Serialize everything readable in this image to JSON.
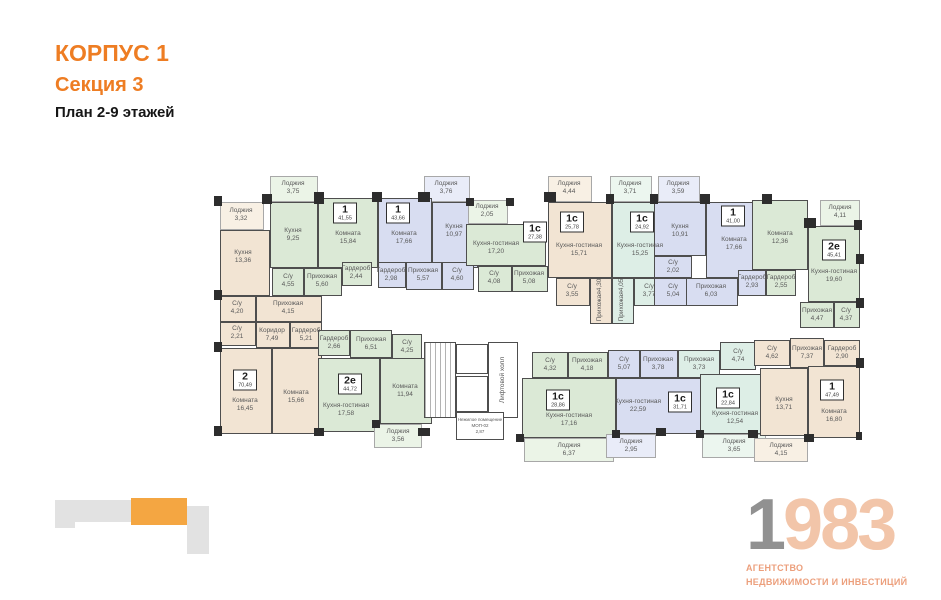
{
  "header": {
    "building": "КОРПУС 1",
    "section": "Секция 3",
    "plan": "План 2-9 этажей"
  },
  "colors": {
    "accent": "#ee7d23",
    "c-bg": "#f2e4d3",
    "c-gn": "#dbe9d6",
    "c-bl": "#d8ddf1",
    "c-mn": "#ddeee6",
    "c-lbg": "#f8f0e4",
    "c-lgn": "#ebf4e7",
    "c-lbl": "#e9ecf8",
    "c-lmn": "#ecf6ef",
    "map-gray": "#e2e2e2",
    "map-orange": "#f4a642",
    "logo-gray": "#919191",
    "logo-salmon": "#f2c5a9",
    "logo-sub": "#ec9f7c"
  },
  "plan": {
    "rooms": [
      {
        "x": 6,
        "y": 44,
        "w": 44,
        "h": 28,
        "c": "lbg"
      },
      {
        "x": 6,
        "y": 72,
        "w": 50,
        "h": 66,
        "c": "bg"
      },
      {
        "x": 6,
        "y": 138,
        "w": 36,
        "h": 26,
        "c": "bg"
      },
      {
        "x": 6,
        "y": 164,
        "w": 36,
        "h": 24,
        "c": "bg"
      },
      {
        "x": 42,
        "y": 138,
        "w": 66,
        "h": 26,
        "c": "bg"
      },
      {
        "x": 42,
        "y": 164,
        "w": 34,
        "h": 26,
        "c": "bg"
      },
      {
        "x": 76,
        "y": 164,
        "w": 32,
        "h": 26,
        "c": "bg"
      },
      {
        "x": 6,
        "y": 190,
        "w": 52,
        "h": 86,
        "c": "bg"
      },
      {
        "x": 58,
        "y": 190,
        "w": 50,
        "h": 86,
        "c": "bg"
      },
      {
        "x": 56,
        "y": 18,
        "w": 48,
        "h": 26,
        "c": "lgn"
      },
      {
        "x": 56,
        "y": 44,
        "w": 48,
        "h": 66,
        "c": "gn"
      },
      {
        "x": 104,
        "y": 40,
        "w": 60,
        "h": 70,
        "c": "gn"
      },
      {
        "x": 58,
        "y": 110,
        "w": 32,
        "h": 28,
        "c": "gn"
      },
      {
        "x": 90,
        "y": 110,
        "w": 38,
        "h": 28,
        "c": "gn"
      },
      {
        "x": 128,
        "y": 104,
        "w": 30,
        "h": 24,
        "c": "gn"
      },
      {
        "x": 210,
        "y": 18,
        "w": 46,
        "h": 26,
        "c": "lbl"
      },
      {
        "x": 164,
        "y": 40,
        "w": 54,
        "h": 70,
        "c": "bl"
      },
      {
        "x": 218,
        "y": 44,
        "w": 46,
        "h": 66,
        "c": "bl"
      },
      {
        "x": 164,
        "y": 104,
        "w": 28,
        "h": 26,
        "c": "bl"
      },
      {
        "x": 192,
        "y": 104,
        "w": 36,
        "h": 28,
        "c": "bl"
      },
      {
        "x": 228,
        "y": 104,
        "w": 32,
        "h": 28,
        "c": "bl"
      },
      {
        "x": 254,
        "y": 42,
        "w": 40,
        "h": 24,
        "c": "lgn"
      },
      {
        "x": 252,
        "y": 66,
        "w": 80,
        "h": 42,
        "c": "gn"
      },
      {
        "x": 264,
        "y": 108,
        "w": 34,
        "h": 26,
        "c": "gn"
      },
      {
        "x": 298,
        "y": 108,
        "w": 36,
        "h": 26,
        "c": "gn"
      },
      {
        "x": 334,
        "y": 18,
        "w": 44,
        "h": 26,
        "c": "lbg"
      },
      {
        "x": 334,
        "y": 44,
        "w": 64,
        "h": 76,
        "c": "bg"
      },
      {
        "x": 342,
        "y": 120,
        "w": 34,
        "h": 28,
        "c": "bg"
      },
      {
        "x": 376,
        "y": 120,
        "w": 22,
        "h": 46,
        "c": "bg"
      },
      {
        "x": 396,
        "y": 18,
        "w": 42,
        "h": 26,
        "c": "lmn"
      },
      {
        "x": 398,
        "y": 44,
        "w": 58,
        "h": 76,
        "c": "mn"
      },
      {
        "x": 398,
        "y": 120,
        "w": 22,
        "h": 46,
        "c": "mn"
      },
      {
        "x": 420,
        "y": 120,
        "w": 32,
        "h": 28,
        "c": "mn"
      },
      {
        "x": 444,
        "y": 18,
        "w": 42,
        "h": 26,
        "c": "lbl"
      },
      {
        "x": 440,
        "y": 44,
        "w": 52,
        "h": 54,
        "c": "bl"
      },
      {
        "x": 440,
        "y": 98,
        "w": 38,
        "h": 22,
        "c": "bl"
      },
      {
        "x": 440,
        "y": 120,
        "w": 38,
        "h": 28,
        "c": "bl"
      },
      {
        "x": 492,
        "y": 44,
        "w": 58,
        "h": 76,
        "c": "bl"
      },
      {
        "x": 472,
        "y": 120,
        "w": 52,
        "h": 28,
        "c": "bl"
      },
      {
        "x": 524,
        "y": 112,
        "w": 28,
        "h": 26,
        "c": "bl"
      },
      {
        "x": 552,
        "y": 112,
        "w": 30,
        "h": 26,
        "c": "gn"
      },
      {
        "x": 538,
        "y": 42,
        "w": 56,
        "h": 70,
        "c": "gn"
      },
      {
        "x": 606,
        "y": 42,
        "w": 40,
        "h": 26,
        "c": "lgn"
      },
      {
        "x": 594,
        "y": 68,
        "w": 52,
        "h": 76,
        "c": "gn"
      },
      {
        "x": 586,
        "y": 144,
        "w": 34,
        "h": 26,
        "c": "gn"
      },
      {
        "x": 620,
        "y": 144,
        "w": 26,
        "h": 26,
        "c": "gn"
      },
      {
        "x": 104,
        "y": 172,
        "w": 32,
        "h": 26,
        "c": "gn"
      },
      {
        "x": 136,
        "y": 172,
        "w": 42,
        "h": 28,
        "c": "gn"
      },
      {
        "x": 178,
        "y": 176,
        "w": 30,
        "h": 26,
        "c": "gn"
      },
      {
        "x": 104,
        "y": 200,
        "w": 62,
        "h": 74,
        "c": "gn"
      },
      {
        "x": 166,
        "y": 200,
        "w": 52,
        "h": 66,
        "c": "gn"
      },
      {
        "x": 160,
        "y": 266,
        "w": 48,
        "h": 24,
        "c": "lgn"
      },
      {
        "x": 210,
        "y": 184,
        "w": 32,
        "h": 76,
        "c": "st"
      },
      {
        "x": 242,
        "y": 186,
        "w": 32,
        "h": 30,
        "c": "wh"
      },
      {
        "x": 242,
        "y": 218,
        "w": 32,
        "h": 36,
        "c": "wh"
      },
      {
        "x": 274,
        "y": 184,
        "w": 30,
        "h": 76,
        "c": "wh"
      },
      {
        "x": 242,
        "y": 254,
        "w": 48,
        "h": 28,
        "c": "wh"
      },
      {
        "x": 318,
        "y": 194,
        "w": 36,
        "h": 26,
        "c": "gn"
      },
      {
        "x": 354,
        "y": 194,
        "w": 40,
        "h": 26,
        "c": "gn"
      },
      {
        "x": 308,
        "y": 220,
        "w": 94,
        "h": 60,
        "c": "gn"
      },
      {
        "x": 310,
        "y": 280,
        "w": 90,
        "h": 24,
        "c": "lgn"
      },
      {
        "x": 394,
        "y": 192,
        "w": 32,
        "h": 28,
        "c": "bl"
      },
      {
        "x": 426,
        "y": 192,
        "w": 38,
        "h": 28,
        "c": "bl"
      },
      {
        "x": 402,
        "y": 220,
        "w": 102,
        "h": 56,
        "c": "bl"
      },
      {
        "x": 392,
        "y": 276,
        "w": 50,
        "h": 24,
        "c": "lbl"
      },
      {
        "x": 464,
        "y": 192,
        "w": 42,
        "h": 28,
        "c": "mn"
      },
      {
        "x": 506,
        "y": 184,
        "w": 36,
        "h": 28,
        "c": "mn"
      },
      {
        "x": 486,
        "y": 216,
        "w": 72,
        "h": 60,
        "c": "mn"
      },
      {
        "x": 488,
        "y": 276,
        "w": 64,
        "h": 24,
        "c": "lmn"
      },
      {
        "x": 540,
        "y": 182,
        "w": 36,
        "h": 26,
        "c": "bg"
      },
      {
        "x": 576,
        "y": 180,
        "w": 34,
        "h": 30,
        "c": "bg"
      },
      {
        "x": 610,
        "y": 182,
        "w": 36,
        "h": 26,
        "c": "bg"
      },
      {
        "x": 546,
        "y": 210,
        "w": 48,
        "h": 68,
        "c": "bg"
      },
      {
        "x": 594,
        "y": 208,
        "w": 52,
        "h": 72,
        "c": "bg"
      },
      {
        "x": 540,
        "y": 280,
        "w": 54,
        "h": 24,
        "c": "lbg"
      }
    ],
    "walls": [
      {
        "x": 48,
        "y": 36,
        "w": 10,
        "h": 10
      },
      {
        "x": 100,
        "y": 34,
        "w": 10,
        "h": 12
      },
      {
        "x": 158,
        "y": 34,
        "w": 10,
        "h": 10
      },
      {
        "x": 204,
        "y": 34,
        "w": 12,
        "h": 10
      },
      {
        "x": 252,
        "y": 40,
        "w": 8,
        "h": 8
      },
      {
        "x": 292,
        "y": 40,
        "w": 8,
        "h": 8
      },
      {
        "x": 330,
        "y": 34,
        "w": 12,
        "h": 10
      },
      {
        "x": 392,
        "y": 36,
        "w": 8,
        "h": 10
      },
      {
        "x": 436,
        "y": 36,
        "w": 8,
        "h": 10
      },
      {
        "x": 486,
        "y": 36,
        "w": 10,
        "h": 10
      },
      {
        "x": 548,
        "y": 36,
        "w": 10,
        "h": 10
      },
      {
        "x": 590,
        "y": 60,
        "w": 12,
        "h": 10
      },
      {
        "x": 640,
        "y": 62,
        "w": 8,
        "h": 10
      },
      {
        "x": 0,
        "y": 38,
        "w": 8,
        "h": 10
      },
      {
        "x": 0,
        "y": 132,
        "w": 8,
        "h": 10
      },
      {
        "x": 0,
        "y": 184,
        "w": 8,
        "h": 10
      },
      {
        "x": 0,
        "y": 268,
        "w": 8,
        "h": 10
      },
      {
        "x": 100,
        "y": 270,
        "w": 10,
        "h": 8
      },
      {
        "x": 158,
        "y": 262,
        "w": 8,
        "h": 8
      },
      {
        "x": 204,
        "y": 270,
        "w": 12,
        "h": 8
      },
      {
        "x": 302,
        "y": 276,
        "w": 8,
        "h": 8
      },
      {
        "x": 398,
        "y": 272,
        "w": 8,
        "h": 8
      },
      {
        "x": 442,
        "y": 270,
        "w": 10,
        "h": 8
      },
      {
        "x": 482,
        "y": 272,
        "w": 8,
        "h": 8
      },
      {
        "x": 534,
        "y": 272,
        "w": 10,
        "h": 8
      },
      {
        "x": 590,
        "y": 276,
        "w": 10,
        "h": 8
      },
      {
        "x": 642,
        "y": 274,
        "w": 6,
        "h": 8
      },
      {
        "x": 642,
        "y": 96,
        "w": 8,
        "h": 10
      },
      {
        "x": 642,
        "y": 140,
        "w": 8,
        "h": 10
      },
      {
        "x": 642,
        "y": 200,
        "w": 8,
        "h": 10
      }
    ],
    "labels": [
      {
        "x": 27,
        "y": 57,
        "n": "Лоджия",
        "a": "3,32"
      },
      {
        "x": 29,
        "y": 99,
        "n": "Кухня",
        "a": "13,36"
      },
      {
        "x": 23,
        "y": 150,
        "n": "С/у",
        "a": "4,20"
      },
      {
        "x": 23,
        "y": 175,
        "n": "С/у",
        "a": "2,21"
      },
      {
        "x": 74,
        "y": 150,
        "n": "Прихожая",
        "a": "4,15"
      },
      {
        "x": 58,
        "y": 177,
        "n": "Коридор",
        "a": "7,49"
      },
      {
        "x": 92,
        "y": 177,
        "n": "Гардероб",
        "a": "5,21"
      },
      {
        "x": 31,
        "y": 247,
        "n": "Комната",
        "a": "16,45"
      },
      {
        "x": 82,
        "y": 239,
        "n": "Комната",
        "a": "15,66"
      },
      {
        "x": 79,
        "y": 30,
        "n": "Лоджия",
        "a": "3,75"
      },
      {
        "x": 79,
        "y": 77,
        "n": "Кухня",
        "a": "9,25"
      },
      {
        "x": 134,
        "y": 80,
        "n": "Комната",
        "a": "15,84"
      },
      {
        "x": 74,
        "y": 123,
        "n": "С/у",
        "a": "4,55"
      },
      {
        "x": 108,
        "y": 123,
        "n": "Прихожая",
        "a": "5,60"
      },
      {
        "x": 142,
        "y": 115,
        "n": "Гардероб",
        "a": "2,44"
      },
      {
        "x": 232,
        "y": 30,
        "n": "Лоджия",
        "a": "3,76"
      },
      {
        "x": 190,
        "y": 80,
        "n": "Комната",
        "a": "17,66"
      },
      {
        "x": 240,
        "y": 73,
        "n": "Кухня",
        "a": "10,97"
      },
      {
        "x": 177,
        "y": 117,
        "n": "Гардероб",
        "a": "2,98"
      },
      {
        "x": 209,
        "y": 117,
        "n": "Прихожая",
        "a": "5,57"
      },
      {
        "x": 243,
        "y": 117,
        "n": "С/у",
        "a": "4,60"
      },
      {
        "x": 273,
        "y": 53,
        "n": "Лоджия",
        "a": "2,05"
      },
      {
        "x": 282,
        "y": 90,
        "n": "Кухня-гостиная",
        "a": "17,20"
      },
      {
        "x": 280,
        "y": 120,
        "n": "С/у",
        "a": "4,08"
      },
      {
        "x": 315,
        "y": 120,
        "n": "Прихожая",
        "a": "5,08"
      },
      {
        "x": 355,
        "y": 30,
        "n": "Лоджия",
        "a": "4,44"
      },
      {
        "x": 365,
        "y": 92,
        "n": "Кухня-гостиная",
        "a": "15,71"
      },
      {
        "x": 358,
        "y": 133,
        "n": "С/у",
        "a": "3,55"
      },
      {
        "x": 386,
        "y": 142,
        "n": "Прихожая",
        "a": "4,30",
        "v": 1
      },
      {
        "x": 416,
        "y": 30,
        "n": "Лоджия",
        "a": "3,71"
      },
      {
        "x": 426,
        "y": 92,
        "n": "Кухня-гостиная",
        "a": "15,25"
      },
      {
        "x": 408,
        "y": 142,
        "n": "Прихожая",
        "a": "4,05",
        "v": 1
      },
      {
        "x": 435,
        "y": 133,
        "n": "С/у",
        "a": "3,77"
      },
      {
        "x": 464,
        "y": 30,
        "n": "Лоджия",
        "a": "3,59"
      },
      {
        "x": 466,
        "y": 73,
        "n": "Кухня",
        "a": "10,91"
      },
      {
        "x": 459,
        "y": 109,
        "n": "С/у",
        "a": "2,02"
      },
      {
        "x": 459,
        "y": 133,
        "n": "С/у",
        "a": "5,04"
      },
      {
        "x": 520,
        "y": 86,
        "n": "Комната",
        "a": "17,66"
      },
      {
        "x": 497,
        "y": 133,
        "n": "Прихожая",
        "a": "6,03"
      },
      {
        "x": 538,
        "y": 124,
        "n": "Гардероб",
        "a": "2,93"
      },
      {
        "x": 567,
        "y": 124,
        "n": "Гардероб",
        "a": "2,55"
      },
      {
        "x": 566,
        "y": 80,
        "n": "Комната",
        "a": "12,36"
      },
      {
        "x": 626,
        "y": 54,
        "n": "Лоджия",
        "a": "4,11"
      },
      {
        "x": 620,
        "y": 118,
        "n": "Кухня-гостиная",
        "a": "19,60"
      },
      {
        "x": 603,
        "y": 157,
        "n": "Прихожая",
        "a": "4,47"
      },
      {
        "x": 632,
        "y": 157,
        "n": "С/у",
        "a": "4,37"
      },
      {
        "x": 120,
        "y": 185,
        "n": "Гардероб",
        "a": "2,66"
      },
      {
        "x": 157,
        "y": 186,
        "n": "Прихожая",
        "a": "6,51"
      },
      {
        "x": 193,
        "y": 189,
        "n": "С/у",
        "a": "4,25"
      },
      {
        "x": 132,
        "y": 252,
        "n": "Кухня-гостиная",
        "a": "17,58"
      },
      {
        "x": 191,
        "y": 233,
        "n": "Комната",
        "a": "11,94"
      },
      {
        "x": 184,
        "y": 278,
        "n": "Лоджия",
        "a": "3,56"
      },
      {
        "x": 266,
        "y": 268,
        "n": "Нежилое помещение МОП-02",
        "a": "2,87",
        "s": 1
      },
      {
        "x": 289,
        "y": 222,
        "n": "Лифтовой холл",
        "a": "",
        "v": 1
      },
      {
        "x": 336,
        "y": 207,
        "n": "С/у",
        "a": "4,32"
      },
      {
        "x": 373,
        "y": 207,
        "n": "Прихожая",
        "a": "4,18"
      },
      {
        "x": 355,
        "y": 262,
        "n": "Кухня-гостиная",
        "a": "17,16"
      },
      {
        "x": 355,
        "y": 292,
        "n": "Лоджия",
        "a": "6,37"
      },
      {
        "x": 410,
        "y": 206,
        "n": "С/у",
        "a": "5,07"
      },
      {
        "x": 444,
        "y": 206,
        "n": "Прихожая",
        "a": "3,78"
      },
      {
        "x": 424,
        "y": 248,
        "n": "Кухня-гостиная",
        "a": "22,59"
      },
      {
        "x": 417,
        "y": 288,
        "n": "Лоджия",
        "a": "2,95"
      },
      {
        "x": 485,
        "y": 206,
        "n": "Прихожая",
        "a": "3,73"
      },
      {
        "x": 524,
        "y": 198,
        "n": "С/у",
        "a": "4,74"
      },
      {
        "x": 521,
        "y": 260,
        "n": "Кухня-гостиная",
        "a": "12,54"
      },
      {
        "x": 520,
        "y": 288,
        "n": "Лоджия",
        "a": "3,65"
      },
      {
        "x": 558,
        "y": 195,
        "n": "С/у",
        "a": "4,62"
      },
      {
        "x": 593,
        "y": 195,
        "n": "Прихожая",
        "a": "7,37"
      },
      {
        "x": 628,
        "y": 195,
        "n": "Гардероб",
        "a": "2,90"
      },
      {
        "x": 570,
        "y": 246,
        "n": "Кухня",
        "a": "13,71"
      },
      {
        "x": 620,
        "y": 258,
        "n": "Комната",
        "a": "16,80"
      },
      {
        "x": 567,
        "y": 292,
        "n": "Лоджия",
        "a": "4,15"
      }
    ],
    "badges": [
      {
        "x": 31,
        "y": 222,
        "t": "2",
        "a": "70,49"
      },
      {
        "x": 131,
        "y": 55,
        "t": "1",
        "a": "41,55"
      },
      {
        "x": 184,
        "y": 55,
        "t": "1",
        "a": "43,66"
      },
      {
        "x": 321,
        "y": 74,
        "t": "1с",
        "a": "27,38"
      },
      {
        "x": 358,
        "y": 64,
        "t": "1с",
        "a": "25,78"
      },
      {
        "x": 428,
        "y": 64,
        "t": "1с",
        "a": "24,92"
      },
      {
        "x": 519,
        "y": 58,
        "t": "1",
        "a": "41,00"
      },
      {
        "x": 620,
        "y": 92,
        "t": "2е",
        "a": "45,41"
      },
      {
        "x": 136,
        "y": 226,
        "t": "2е",
        "a": "44,72"
      },
      {
        "x": 344,
        "y": 242,
        "t": "1с",
        "a": "28,86"
      },
      {
        "x": 466,
        "y": 244,
        "t": "1с",
        "a": "31,71"
      },
      {
        "x": 514,
        "y": 240,
        "t": "1с",
        "a": "22,84"
      },
      {
        "x": 618,
        "y": 232,
        "t": "1",
        "a": "47,49"
      }
    ]
  },
  "minimap": {
    "blocks": [
      {
        "x": 0,
        "y": 2,
        "w": 20,
        "h": 28,
        "hl": false
      },
      {
        "x": 20,
        "y": 2,
        "w": 56,
        "h": 22,
        "hl": false
      },
      {
        "x": 76,
        "y": 0,
        "w": 56,
        "h": 27,
        "hl": true
      },
      {
        "x": 132,
        "y": 8,
        "w": 22,
        "h": 48,
        "hl": false
      }
    ]
  },
  "logo": {
    "digit_gray": "1",
    "digits_salmon": "983",
    "line1": "АГЕНТСТВО",
    "line2": "НЕДВИЖИМОСТИ И ИНВЕСТИЦИЙ"
  }
}
